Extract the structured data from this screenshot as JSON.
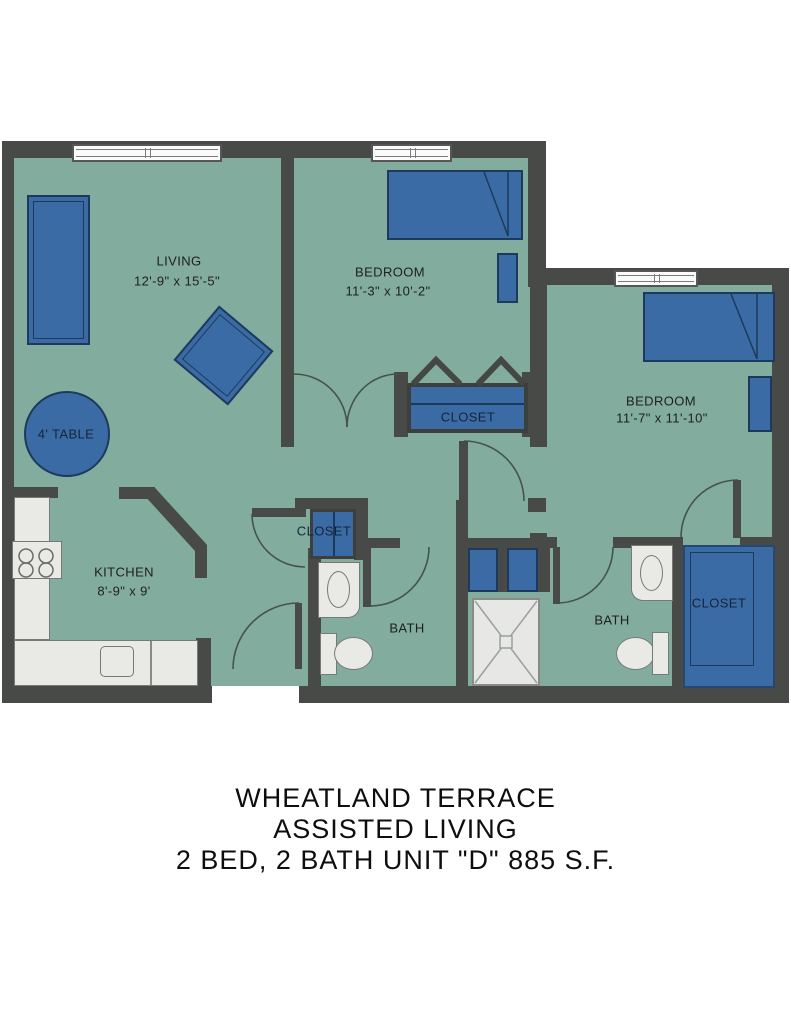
{
  "plan": {
    "colors": {
      "wall": "#474a47",
      "floor": "#82ac9e",
      "furniture_fill": "#3a6ba5",
      "furniture_border": "#1d3a5c",
      "fixture_fill": "#e9e9e6",
      "fixture_border": "#787878",
      "door_arc": "#46534c",
      "label_text": "#1f1f1f",
      "closet_text": "#16243a"
    },
    "rooms": {
      "living": {
        "name": "LIVING",
        "dims": "12'-9\" x 15'-5\""
      },
      "bedroom1": {
        "name": "BEDROOM",
        "dims": "11'-3\" x 10'-2\""
      },
      "bedroom2": {
        "name": "BEDROOM",
        "dims": "11'-7\" x 11'-10\""
      },
      "kitchen": {
        "name": "KITCHEN",
        "dims": "8'-9\" x 9'"
      },
      "bath1": {
        "name": "BATH"
      },
      "bath2": {
        "name": "BATH"
      },
      "closet_hall": {
        "name": "CLOSET"
      },
      "closet_bedroom1": {
        "name": "CLOSET"
      },
      "closet_bedroom2": {
        "name": "CLOSET"
      },
      "table": {
        "name": "4' TABLE"
      }
    },
    "title": {
      "line1": "WHEATLAND TERRACE",
      "line2": "ASSISTED LIVING",
      "line3": "2 BED, 2 BATH UNIT \"D\" 885 S.F."
    }
  }
}
